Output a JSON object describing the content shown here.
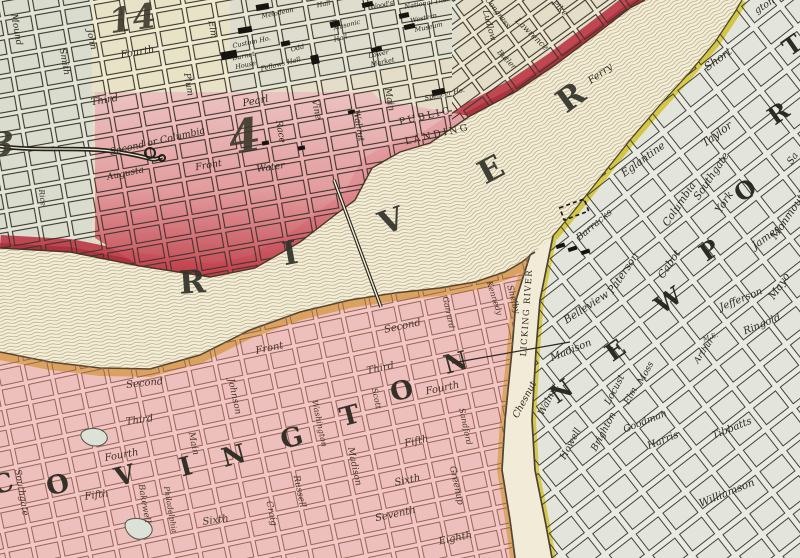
{
  "map": {
    "region_names": [
      "Cincinnati district",
      "Ohio River",
      "Covington",
      "Newport",
      "Licking River"
    ],
    "palette": {
      "paper": "#efe9d6",
      "cincinnati_block_tint": "#ece6d0",
      "riverfront_red": "#c23f4c",
      "district4_pink": "#f2bcc0",
      "covington_pink": "#f1c8c5",
      "newport_grey": "#e9ebe3",
      "covington_bank_tan": "#dca75b",
      "newport_bank_yellow": "#d8c93c",
      "river_hatch": "#a5976e",
      "ink": "#2f2a20"
    },
    "cincinnati": {
      "district_numbers": [
        {
          "t": "14",
          "x": 134,
          "y": 30,
          "r": -8,
          "s": 34
        },
        {
          "t": "4",
          "x": 247,
          "y": 152,
          "r": -10,
          "s": 46
        },
        {
          "t": "3",
          "x": 2,
          "y": 156,
          "r": 0,
          "s": 34
        }
      ],
      "streets": [
        {
          "t": "Mound",
          "x": 14,
          "y": 30,
          "r": 80,
          "s": 9
        },
        {
          "t": "Smith",
          "x": 62,
          "y": 62,
          "r": 80,
          "s": 9
        },
        {
          "t": "John",
          "x": 89,
          "y": 40,
          "r": 78,
          "s": 9
        },
        {
          "t": "Fourth",
          "x": 138,
          "y": 55,
          "r": -10,
          "s": 10
        },
        {
          "t": "Third",
          "x": 105,
          "y": 103,
          "r": -10,
          "s": 10
        },
        {
          "t": "Plum",
          "x": 186,
          "y": 85,
          "r": 80,
          "s": 9
        },
        {
          "t": "Elm",
          "x": 210,
          "y": 30,
          "r": 80,
          "s": 9
        },
        {
          "t": "Race",
          "x": 278,
          "y": 132,
          "r": 80,
          "s": 9
        },
        {
          "t": "Vine",
          "x": 314,
          "y": 110,
          "r": 78,
          "s": 9
        },
        {
          "t": "Walnut",
          "x": 356,
          "y": 126,
          "r": 80,
          "s": 9
        },
        {
          "t": "Main",
          "x": 387,
          "y": 100,
          "r": 80,
          "s": 9
        },
        {
          "t": "Pearl",
          "x": 256,
          "y": 104,
          "r": -10,
          "s": 10
        },
        {
          "t": "Second or Columbia",
          "x": 158,
          "y": 144,
          "r": -13,
          "s": 9.5
        },
        {
          "t": "Augusta",
          "x": 126,
          "y": 176,
          "r": -12,
          "s": 9
        },
        {
          "t": "Front",
          "x": 209,
          "y": 168,
          "r": -10,
          "s": 9.5
        },
        {
          "t": "Water",
          "x": 271,
          "y": 170,
          "r": -8,
          "s": 9.5
        },
        {
          "t": "Ludlow",
          "x": 487,
          "y": 26,
          "r": 75,
          "s": 8.5
        },
        {
          "t": "Lawrence",
          "x": 530,
          "y": 36,
          "r": 44,
          "s": 8.5
        },
        {
          "t": "Pike",
          "x": 558,
          "y": 10,
          "r": 44,
          "s": 8.5
        },
        {
          "t": "Congress",
          "x": 496,
          "y": 14,
          "r": 52,
          "s": 7.5
        },
        {
          "t": "Butler",
          "x": 505,
          "y": 61,
          "r": 46,
          "s": 7.5
        },
        {
          "t": "Rice",
          "x": 40,
          "y": 198,
          "r": 82,
          "s": 7.5
        }
      ],
      "buildings": [
        {
          "t": "Custom Ho.",
          "x": 252,
          "y": 44,
          "r": -12,
          "s": 6.5
        },
        {
          "t": "Burnet",
          "x": 244,
          "y": 58,
          "r": -12,
          "s": 6.5
        },
        {
          "t": "House",
          "x": 246,
          "y": 67,
          "r": -12,
          "s": 6.5
        },
        {
          "t": "Melodeon",
          "x": 278,
          "y": 15,
          "r": -12,
          "s": 6.5
        },
        {
          "t": "Hall",
          "x": 324,
          "y": 6,
          "r": -12,
          "s": 6.5
        },
        {
          "t": "Masonic",
          "x": 347,
          "y": 27,
          "r": -14,
          "s": 6.5
        },
        {
          "t": "Hall",
          "x": 341,
          "y": 40,
          "r": -14,
          "s": 6.5
        },
        {
          "t": "Wood's",
          "x": 382,
          "y": 7,
          "r": -12,
          "s": 6.5
        },
        {
          "t": "National The.",
          "x": 427,
          "y": 5,
          "r": -10,
          "s": 6.5
        },
        {
          "t": "Western",
          "x": 424,
          "y": 20,
          "r": -12,
          "s": 6.5
        },
        {
          "t": "Museum",
          "x": 429,
          "y": 29,
          "r": -12,
          "s": 6.5
        },
        {
          "t": "Lower",
          "x": 379,
          "y": 56,
          "r": -12,
          "s": 6.5
        },
        {
          "t": "Market",
          "x": 383,
          "y": 64,
          "r": -12,
          "s": 6.5
        },
        {
          "t": "Odd",
          "x": 298,
          "y": 50,
          "r": -14,
          "s": 6.5
        },
        {
          "t": "Fellows Hall",
          "x": 281,
          "y": 66,
          "r": -14,
          "s": 6.5
        },
        {
          "t": "Spencer Ho.",
          "x": 445,
          "y": 96,
          "r": -12,
          "s": 6.5
        }
      ]
    },
    "river": {
      "name_letters": [
        {
          "t": "R",
          "x": 193,
          "y": 293,
          "r": -4,
          "s": 32
        },
        {
          "t": "I",
          "x": 292,
          "y": 264,
          "r": -10,
          "s": 32
        },
        {
          "t": "V",
          "x": 395,
          "y": 231,
          "r": -20,
          "s": 32
        },
        {
          "t": "E",
          "x": 496,
          "y": 179,
          "r": -28,
          "s": 32
        },
        {
          "t": "R",
          "x": 577,
          "y": 106,
          "r": -36,
          "s": 32
        }
      ],
      "labels": [
        {
          "t": "Ferry",
          "x": 602,
          "y": 76,
          "r": -36,
          "s": 10
        },
        {
          "t": "PUBLIC",
          "x": 426,
          "y": 119,
          "r": -13,
          "s": 9.5,
          "ls": 2.5,
          "c": "sc"
        },
        {
          "t": "LANDING",
          "x": 438,
          "y": 137,
          "r": -13,
          "s": 9.5,
          "ls": 2.5,
          "c": "sc"
        }
      ]
    },
    "covington": {
      "big_letters": [
        {
          "t": "C",
          "x": 5,
          "y": 492,
          "r": -15,
          "s": 26
        },
        {
          "t": "O",
          "x": 60,
          "y": 493,
          "r": -15,
          "s": 26
        },
        {
          "t": "V",
          "x": 127,
          "y": 484,
          "r": -15,
          "s": 26
        },
        {
          "t": "I",
          "x": 188,
          "y": 475,
          "r": -15,
          "s": 26
        },
        {
          "t": "N",
          "x": 236,
          "y": 464,
          "r": -15,
          "s": 26
        },
        {
          "t": "G",
          "x": 294,
          "y": 446,
          "r": -15,
          "s": 26
        },
        {
          "t": "T",
          "x": 352,
          "y": 424,
          "r": -15,
          "s": 26
        },
        {
          "t": "O",
          "x": 404,
          "y": 399,
          "r": -15,
          "s": 26
        },
        {
          "t": "N",
          "x": 458,
          "y": 371,
          "r": -15,
          "s": 26
        }
      ],
      "streets": [
        {
          "t": "Front",
          "x": 270,
          "y": 351,
          "r": -12,
          "s": 10
        },
        {
          "t": "Second",
          "x": 403,
          "y": 329,
          "r": -12,
          "s": 10
        },
        {
          "t": "Third",
          "x": 381,
          "y": 371,
          "r": -12,
          "s": 10
        },
        {
          "t": "Fourth",
          "x": 443,
          "y": 391,
          "r": -12,
          "s": 10
        },
        {
          "t": "Fifth",
          "x": 417,
          "y": 444,
          "r": -12,
          "s": 10
        },
        {
          "t": "Sixth",
          "x": 408,
          "y": 483,
          "r": -12,
          "s": 10
        },
        {
          "t": "Seventh",
          "x": 396,
          "y": 517,
          "r": -12,
          "s": 10
        },
        {
          "t": "Eighth",
          "x": 456,
          "y": 541,
          "r": -12,
          "s": 10
        },
        {
          "t": "Second",
          "x": 145,
          "y": 386,
          "r": -6,
          "s": 10
        },
        {
          "t": "Third",
          "x": 140,
          "y": 423,
          "r": -8,
          "s": 10
        },
        {
          "t": "Fourth",
          "x": 122,
          "y": 458,
          "r": -10,
          "s": 10
        },
        {
          "t": "Fifth",
          "x": 97,
          "y": 498,
          "r": -8,
          "s": 10
        },
        {
          "t": "Sixth",
          "x": 216,
          "y": 523,
          "r": -8,
          "s": 10
        },
        {
          "t": "Johnson",
          "x": 232,
          "y": 397,
          "r": 78,
          "s": 9
        },
        {
          "t": "Main",
          "x": 191,
          "y": 444,
          "r": 78,
          "s": 9
        },
        {
          "t": "Bakewell",
          "x": 142,
          "y": 504,
          "r": 80,
          "s": 8.5
        },
        {
          "t": "Philadelphia",
          "x": 168,
          "y": 510,
          "r": 80,
          "s": 7.5
        },
        {
          "t": "Southgate",
          "x": 19,
          "y": 493,
          "r": 80,
          "s": 9
        },
        {
          "t": "Craig",
          "x": 269,
          "y": 514,
          "r": 78,
          "s": 9
        },
        {
          "t": "Russell",
          "x": 297,
          "y": 492,
          "r": 78,
          "s": 9
        },
        {
          "t": "Washington",
          "x": 317,
          "y": 424,
          "r": 78,
          "s": 8
        },
        {
          "t": "Madison",
          "x": 352,
          "y": 467,
          "r": 78,
          "s": 9
        },
        {
          "t": "Scott",
          "x": 374,
          "y": 399,
          "r": 78,
          "s": 8
        },
        {
          "t": "Garrard",
          "x": 446,
          "y": 313,
          "r": 78,
          "s": 8
        },
        {
          "t": "Sandford",
          "x": 463,
          "y": 427,
          "r": 78,
          "s": 8
        },
        {
          "t": "Greenup",
          "x": 454,
          "y": 486,
          "r": 78,
          "s": 9
        },
        {
          "t": "Kennedy",
          "x": 492,
          "y": 299,
          "r": 72,
          "s": 8
        },
        {
          "t": "Shelby",
          "x": 511,
          "y": 300,
          "r": 75,
          "s": 8.5
        }
      ]
    },
    "newport": {
      "big_letters": [
        {
          "t": "N",
          "x": 566,
          "y": 398,
          "r": -35,
          "s": 24
        },
        {
          "t": "E",
          "x": 620,
          "y": 357,
          "r": -35,
          "s": 24
        },
        {
          "t": "W",
          "x": 673,
          "y": 307,
          "r": -35,
          "s": 24
        },
        {
          "t": "P",
          "x": 714,
          "y": 257,
          "r": -35,
          "s": 24
        },
        {
          "t": "O",
          "x": 750,
          "y": 197,
          "r": -35,
          "s": 24
        },
        {
          "t": "R",
          "x": 783,
          "y": 120,
          "r": -35,
          "s": 24
        },
        {
          "t": "T",
          "x": 797,
          "y": 52,
          "r": -35,
          "s": 24
        }
      ],
      "streets": [
        {
          "t": "Short",
          "x": 720,
          "y": 62,
          "r": -36,
          "s": 11
        },
        {
          "t": "Taylor",
          "x": 719,
          "y": 137,
          "r": -36,
          "s": 11
        },
        {
          "t": "Eglantine",
          "x": 645,
          "y": 162,
          "r": -36,
          "s": 10.5
        },
        {
          "t": "Southgate",
          "x": 714,
          "y": 178,
          "r": -56,
          "s": 10.5
        },
        {
          "t": "Columbia",
          "x": 682,
          "y": 206,
          "r": -56,
          "s": 10.5
        },
        {
          "t": "York",
          "x": 727,
          "y": 204,
          "r": -56,
          "s": 10.5
        },
        {
          "t": "Monmouth",
          "x": 792,
          "y": 216,
          "r": -56,
          "s": 10.5
        },
        {
          "t": "Paterson",
          "x": 626,
          "y": 275,
          "r": -56,
          "s": 10.5
        },
        {
          "t": "Cabot",
          "x": 672,
          "y": 266,
          "r": -56,
          "s": 10.5
        },
        {
          "t": "Belleview",
          "x": 588,
          "y": 310,
          "r": -33,
          "s": 10.5
        },
        {
          "t": "James",
          "x": 768,
          "y": 240,
          "r": -36,
          "s": 10.5
        },
        {
          "t": "Jefferson",
          "x": 742,
          "y": 302,
          "r": -22,
          "s": 10
        },
        {
          "t": "Mayo",
          "x": 782,
          "y": 288,
          "r": -56,
          "s": 10.5
        },
        {
          "t": "Ringold",
          "x": 763,
          "y": 327,
          "r": -22,
          "s": 10
        },
        {
          "t": "Madison",
          "x": 572,
          "y": 353,
          "r": -22,
          "s": 10
        },
        {
          "t": "Walnut",
          "x": 551,
          "y": 401,
          "r": -62,
          "s": 9.5
        },
        {
          "t": "Chesnut",
          "x": 527,
          "y": 401,
          "r": -62,
          "s": 9.5
        },
        {
          "t": "Howell",
          "x": 573,
          "y": 445,
          "r": -62,
          "s": 9.5
        },
        {
          "t": "Brighton",
          "x": 606,
          "y": 433,
          "r": -62,
          "s": 9.5
        },
        {
          "t": "Locust",
          "x": 617,
          "y": 391,
          "r": -62,
          "s": 9.5
        },
        {
          "t": "Elm",
          "x": 633,
          "y": 397,
          "r": -62,
          "s": 9
        },
        {
          "t": "Moss",
          "x": 648,
          "y": 374,
          "r": -62,
          "s": 9
        },
        {
          "t": "Goodman",
          "x": 646,
          "y": 424,
          "r": -22,
          "s": 9.5
        },
        {
          "t": "Harris",
          "x": 664,
          "y": 443,
          "r": -22,
          "s": 10
        },
        {
          "t": "Tibbatts",
          "x": 733,
          "y": 431,
          "r": -22,
          "s": 10
        },
        {
          "t": "Williamson",
          "x": 728,
          "y": 496,
          "r": -22,
          "s": 10.5
        },
        {
          "t": "Arthur",
          "x": 706,
          "y": 352,
          "r": -56,
          "s": 8.5
        },
        {
          "t": "M.E.",
          "x": 711,
          "y": 339,
          "r": -20,
          "s": 6.5
        }
      ],
      "landmarks": [
        {
          "t": "Barracks",
          "x": 596,
          "y": 227,
          "r": -40,
          "s": 9.5
        }
      ]
    },
    "licking_river": {
      "labels": [
        {
          "t": "LICKING RIVER",
          "x": 529,
          "y": 313,
          "r": -86,
          "s": 8.5,
          "ls": 1.3,
          "c": "sc"
        }
      ]
    },
    "edge_partials": [
      {
        "t": "gton",
        "x": 766,
        "y": 8,
        "r": -33,
        "s": 9.5
      },
      {
        "t": "Sa",
        "x": 795,
        "y": 160,
        "r": -56,
        "s": 9.5
      }
    ]
  }
}
